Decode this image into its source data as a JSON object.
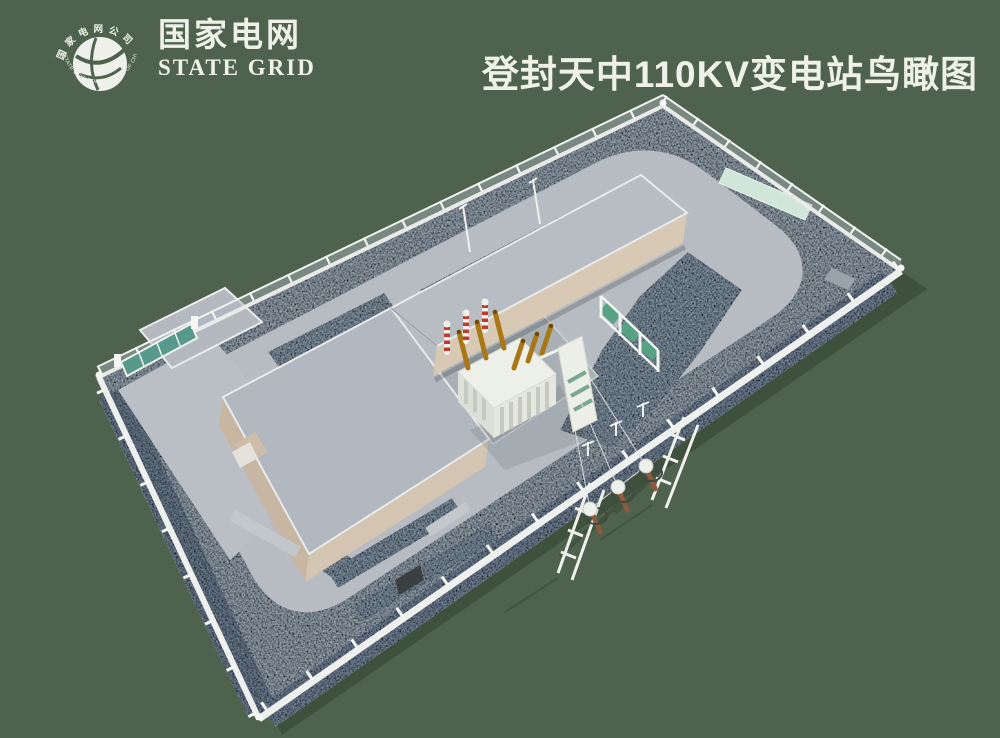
{
  "header": {
    "logo_cn": "国家电网",
    "logo_en": "STATE GRID",
    "title": "登封天中110KV变电站鸟瞰图",
    "emblem": {
      "arc_top": "国家电网公司",
      "arc_bottom": "STATE GRID CORPORATION OF CHINA"
    }
  },
  "scene": {
    "colors": {
      "background": "#4e624d",
      "cast_shadow": "#3f513d",
      "gravel_base": "#93a2b0",
      "gravel_dark": "#76879a",
      "road_gray": "#b6bcc2",
      "roof_gray": "#b2b8bf",
      "wall_tan": "#d5c6b2",
      "fence_white": "#eef1ee",
      "gate_teal": "#579a8b",
      "screen_green": "#57a184",
      "mint_pad": "#cfe6d8",
      "transformer_white": "#edefe9",
      "bushing_amber": "#a97716",
      "arrester_red": "#c0392e"
    },
    "parts": [
      "state-grid-emblem",
      "substation-site",
      "perimeter-fence",
      "loop-road",
      "entrance-gate",
      "entrance-apron",
      "main-building",
      "equipment-wing",
      "transformer-yard",
      "main-transformer",
      "surge-arresters",
      "gis-gantry",
      "safety-screen-fence",
      "mint-pad",
      "terminal-poles",
      "line-frames"
    ]
  }
}
